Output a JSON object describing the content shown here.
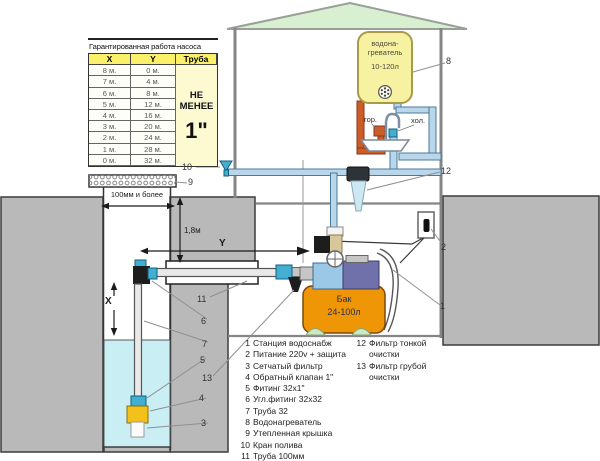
{
  "table": {
    "title": "Гарантированная работа насоса",
    "columns": {
      "x": "X",
      "y": "Y",
      "pipe": "Труба"
    },
    "rows": [
      {
        "x": "8 м.",
        "y": "0 м."
      },
      {
        "x": "7 м.",
        "y": "4 м."
      },
      {
        "x": "6 м.",
        "y": "8 м."
      },
      {
        "x": "5 м.",
        "y": "12 м."
      },
      {
        "x": "4 м.",
        "y": "16 м."
      },
      {
        "x": "3 м.",
        "y": "20 м."
      },
      {
        "x": "2 м.",
        "y": "24 м."
      },
      {
        "x": "1 м.",
        "y": "28 м."
      },
      {
        "x": "0 м.",
        "y": "32 м."
      }
    ],
    "pipe_note_line1": "НЕ",
    "pipe_note_line2": "МЕНЕЕ",
    "pipe_size": "1\""
  },
  "heater": {
    "line1": "водона-",
    "line2": "греватель",
    "capacity": "10-120л"
  },
  "sink": {
    "hot": "гор.",
    "cold": "хол."
  },
  "tank": {
    "line1": "Бак",
    "line2": "24-100л"
  },
  "dims": {
    "x": "X",
    "y": "Y",
    "depth": "1,8м",
    "well_width": "100мм и более"
  },
  "callouts": {
    "c1": "1",
    "c2": "2",
    "c3": "3",
    "c4": "4",
    "c5": "5",
    "c6": "6",
    "c7": "7",
    "c8": "8",
    "c9": "9",
    "c10": "10",
    "c11": "11",
    "c12": "12",
    "c13": "13"
  },
  "legend": {
    "left": [
      {
        "num": "1",
        "text": "Станция водоснабж"
      },
      {
        "num": "2",
        "text": "Питание 220v + защита"
      },
      {
        "num": "3",
        "text": "Сетчатый фильтр"
      },
      {
        "num": "4",
        "text": "Обратный клапан 1\""
      },
      {
        "num": "5",
        "text": "Фитинг 32х1\""
      },
      {
        "num": "6",
        "text": "Угл.фитинг 32х32"
      },
      {
        "num": "7",
        "text": "Труба 32"
      },
      {
        "num": "8",
        "text": "Водонагреватель"
      },
      {
        "num": "9",
        "text": "Утепленная крышка"
      },
      {
        "num": "10",
        "text": "Кран полива"
      },
      {
        "num": "11",
        "text": "Труба 100мм"
      }
    ],
    "right": [
      {
        "num": "12",
        "text": "Фильтр тонкой",
        "text2": "очистки"
      },
      {
        "num": "13",
        "text": "Фильтр грубой",
        "text2": "очистки"
      }
    ]
  },
  "colors": {
    "soil": "#b9b9b9",
    "water": "#c9eef3",
    "roof": "#d9efd2",
    "heater": "#f7f2a2",
    "heater-border": "#a89a48",
    "tank": "#ef9607",
    "pipe": "#b9d6ea",
    "pipe-stroke": "#4a7a9a",
    "hot": "#cc5c28",
    "hot-stroke": "#8a3618",
    "fitting": "#42aed2",
    "valve-yellow": "#f2c21a",
    "table-header": "#fbf06a",
    "motor": "#7070aa",
    "pump-body": "#9cc8e8"
  }
}
